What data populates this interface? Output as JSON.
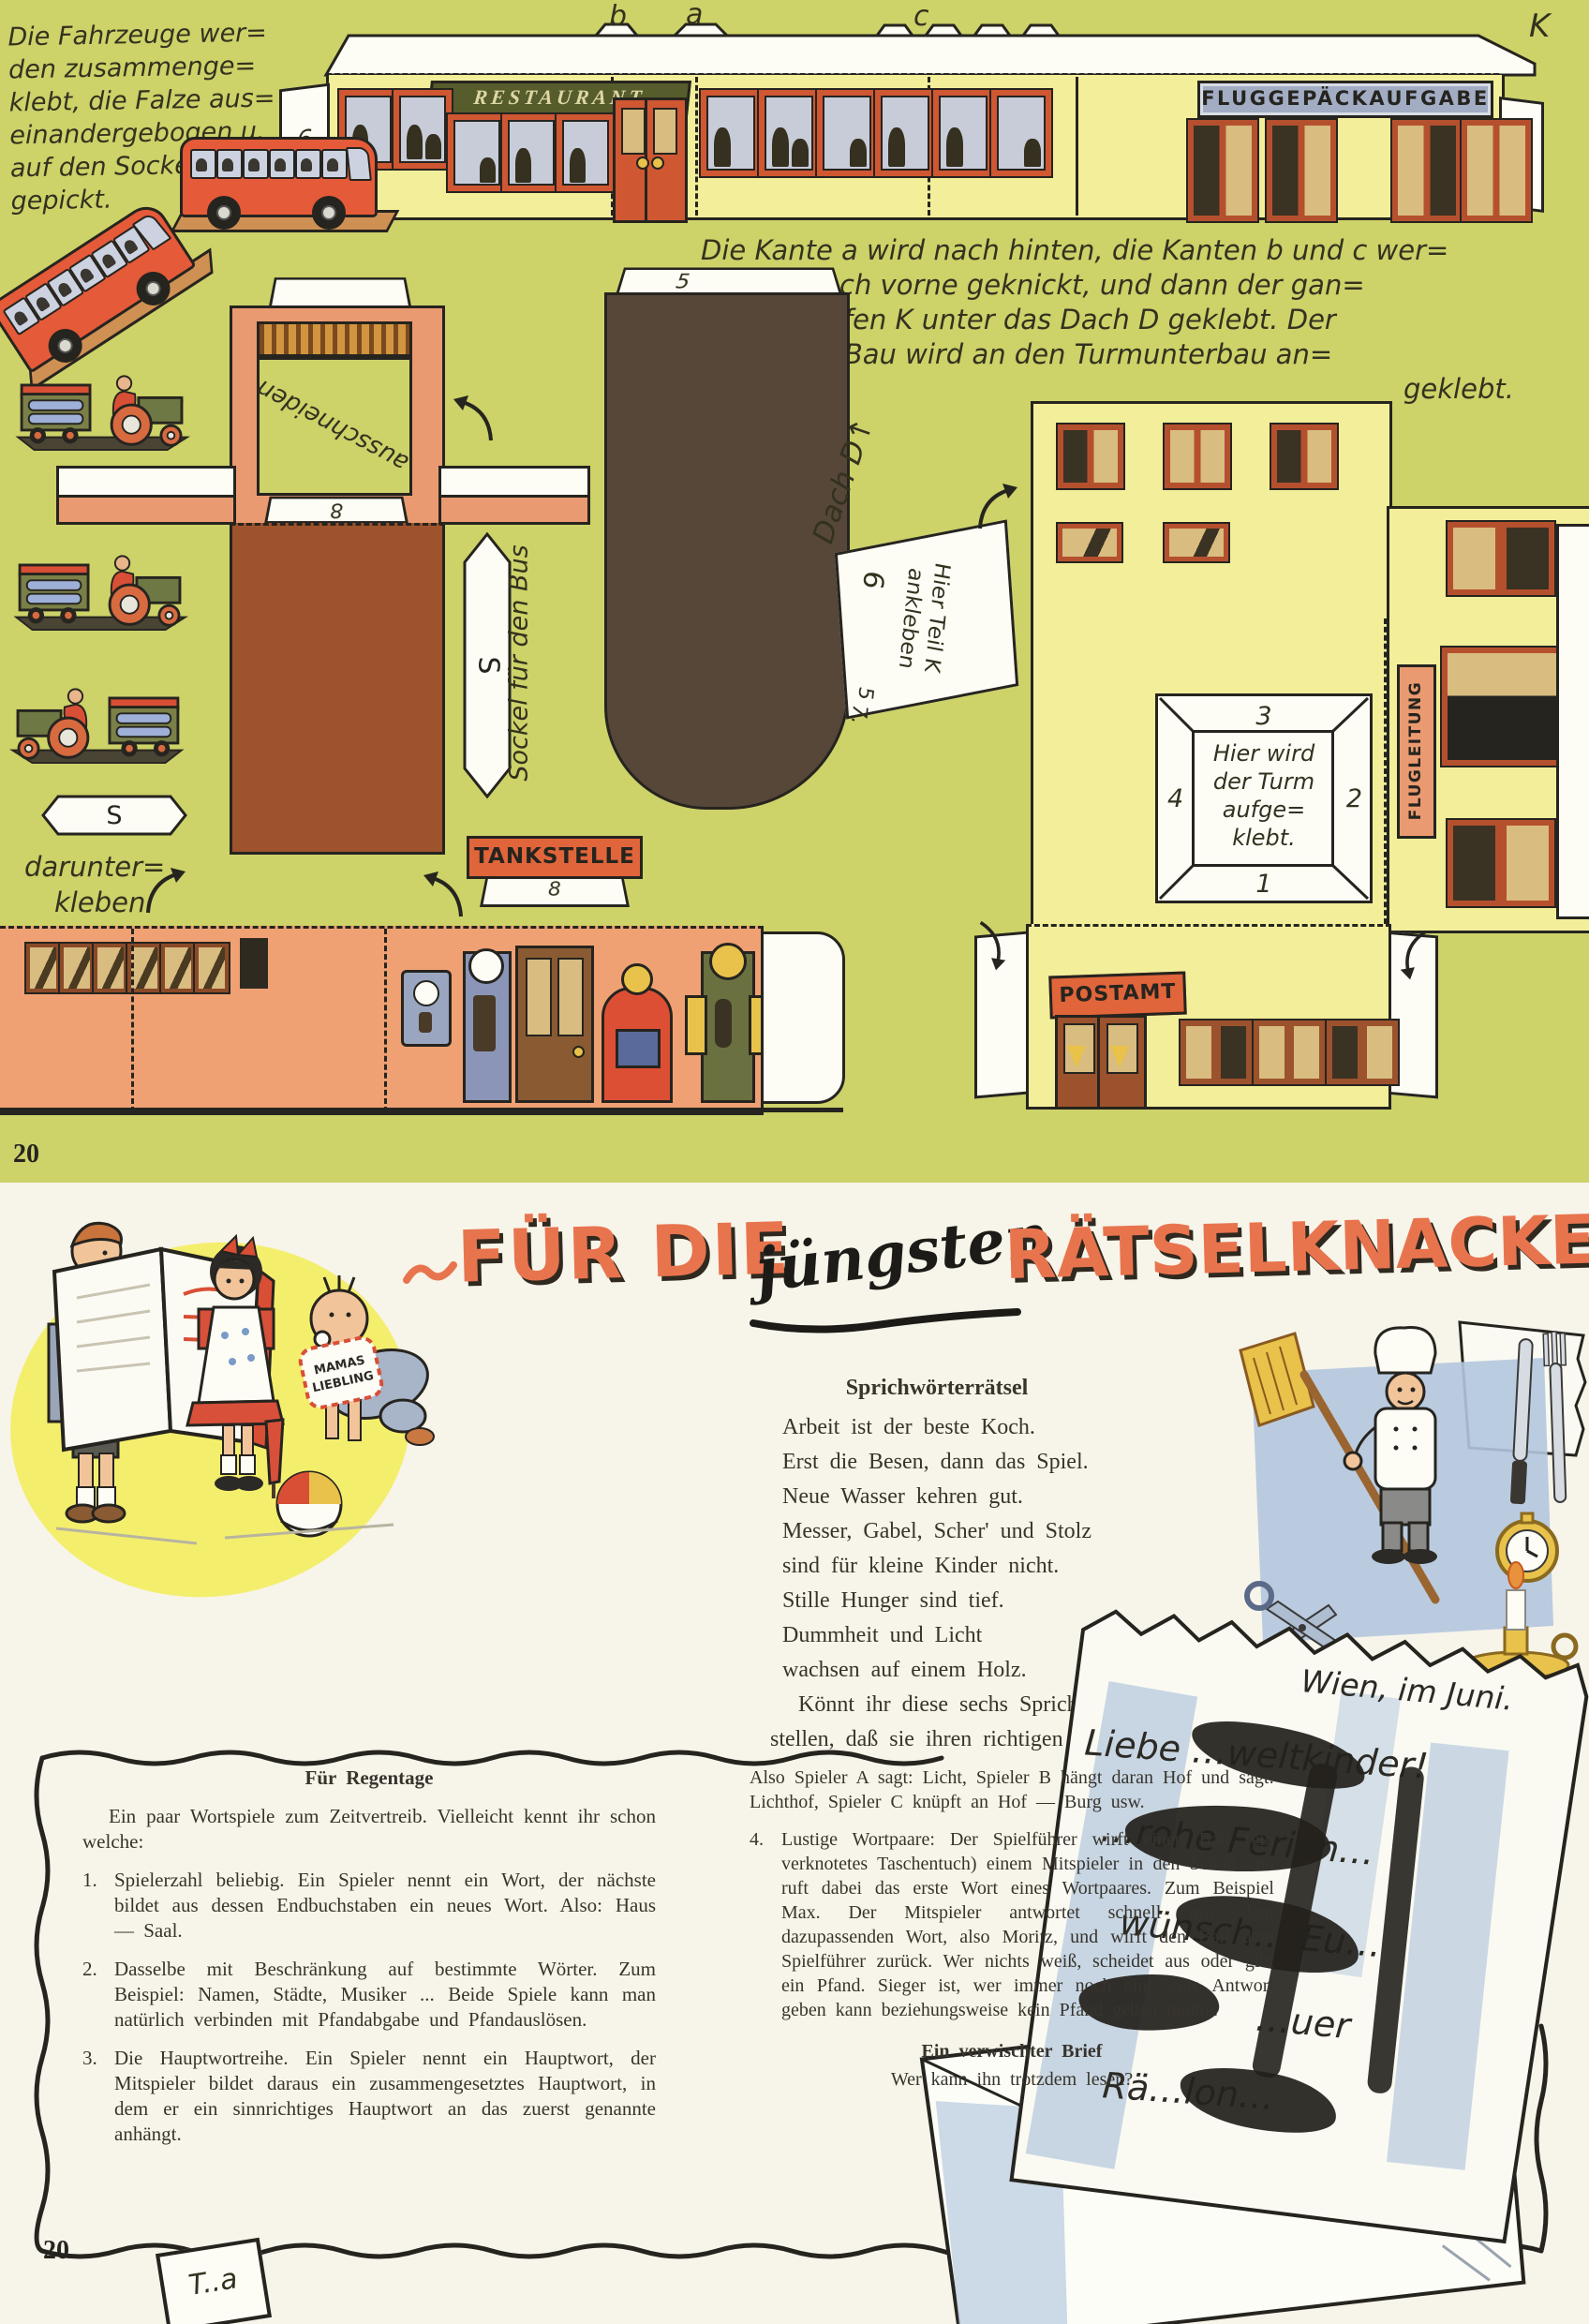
{
  "craft": {
    "page_number": "20",
    "note_vehicles": [
      "Die Fahrzeuge wer=",
      "den zusammenge=",
      "klebt, die Falze aus=",
      "einandergebogen u.",
      "auf den Sockel S",
      "gepickt."
    ],
    "note_assembly": [
      "Die Kante a wird nach hinten, die Kanten b und c wer=",
      "den nach vorne geknickt, und dann der gan=",
      "ze Streifen K unter das Dach D geklebt. Der",
      "ganze Bau wird an den Turmunterbau an=",
      "geklebt."
    ],
    "strip": {
      "tab_b": "b",
      "tab_a": "a",
      "tab_c": "c",
      "corner_label": "K",
      "flap_left_number": "6",
      "flap_right_number": "7",
      "restaurant_sign": "RESTAURANT",
      "baggage_sign": "FLUGGEPÄCKAUFGABE"
    },
    "tower": {
      "cut_label": "ausschneiden",
      "tab_number": "8"
    },
    "roof_piece": {
      "tab_number": "5",
      "label": "Dach D↑"
    },
    "k_panel": {
      "number_top": "6",
      "line1": "Hier Teil K",
      "line2": "ankleben",
      "number_side": "5",
      "number_bottom": "7."
    },
    "turm_square": {
      "top": "3",
      "right": "2",
      "bottom": "1",
      "left": "4",
      "lines": [
        "Hier wird",
        "der Turm",
        "aufge=",
        "klebt."
      ]
    },
    "flugleitung_sign": "FLUGLEITUNG",
    "postamt_sign": "POSTAMT",
    "tankstelle": {
      "sign": "TANKSTELLE",
      "tab_number": "8"
    },
    "socket_banner": {
      "letter": "S",
      "label": "Sockel für den Bus"
    },
    "socket_small_letter": "S",
    "note_glue_under": [
      "darunter=",
      "kleben"
    ]
  },
  "puzzle": {
    "title": {
      "part1": "FÜR DIE",
      "part2": "jüngsten",
      "part3": "RÄTSELKNACKER"
    },
    "bib": {
      "line1": "MAMAS",
      "line2": "LIEBLING"
    },
    "sprichwoerter": {
      "heading": "Sprichwörterrätsel",
      "lines": [
        "Arbeit ist der beste Koch.",
        "Erst die Besen, dann das Spiel.",
        "Neue Wasser kehren gut.",
        "Messer, Gabel, Scher' und Stolz",
        "sind für kleine Kinder nicht.",
        "Stille Hunger sind tief.",
        "Dummheit und Licht",
        "wachsen auf einem Holz."
      ],
      "question_line1": "Könnt ihr diese sechs Sprichwörter so um-",
      "question_line2": "stellen, daß sie ihren richtigen Sinn erhalten?"
    },
    "regentage": {
      "heading": "Für Regentage",
      "intro": "Ein paar Wortspiele zum Zeitvertreib. Vielleicht kennt ihr schon welche:",
      "items": [
        {
          "num": "1.",
          "text": "Spielerzahl beliebig. Ein Spieler nennt ein Wort, der nächste bildet aus dessen Endbuchstaben ein neues Wort. Also: Haus — Saal."
        },
        {
          "num": "2.",
          "text": "Dasselbe mit Beschränkung auf bestimmte Wörter. Zum Beispiel: Namen, Städte, Musiker ... Beide Spiele kann man natürlich verbinden mit Pfandabgabe und Pfandauslösen."
        },
        {
          "num": "3.",
          "text": "Die Hauptwortreihe. Ein Spieler nennt ein Hauptwort, der Mitspieler bildet daraus ein zusammengesetztes Hauptwort, in dem er ein sinnrichtiges Hauptwort an das zuerst genannte anhängt."
        }
      ]
    },
    "games2": {
      "intro": "Also Spieler A sagt: Licht, Spieler B hängt daran Hof und sagt: Lichthof, Spieler C knüpft an Hof — Burg usw.",
      "item4_num": "4.",
      "item4_text": "Lustige Wortpaare: Der Spielführer wirft einen Ball (ein verknotetes Taschentuch) einem Mitspieler in den Schoß und ruft dabei das erste Wort eines Wortpaares. Zum Beispiel Max. Der Mitspieler antwortet schnell mit dem dazupassenden Wort, also Moritz, und wirft den Ball dem Spielführer zurück. Wer nichts weiß, scheidet aus oder gibt ein Pfand. Sieger ist, wer immer noch eine gute Antwort geben kann beziehungsweise kein Pfand geben mußte.",
      "brief_heading": "Ein verwischter Brief",
      "brief_question": "Wer kann ihn trotzdem lesen?"
    },
    "letter": {
      "dateline": "Wien, im Juni.",
      "smudged_lines": [
        "Liebe …weltkinder!",
        "…rohe Ferien…",
        "wünsch… Eu…",
        "…uer",
        "Rä…lon…"
      ]
    },
    "footer": {
      "page_number": "20",
      "tag_label": "T..a"
    }
  }
}
